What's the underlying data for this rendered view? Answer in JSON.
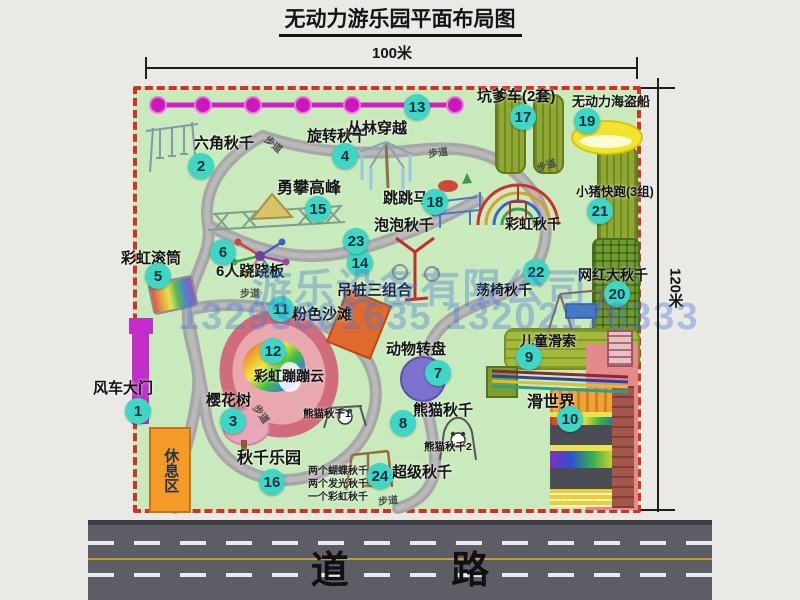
{
  "title": "无动力游乐园平面布局图",
  "dims": {
    "width": "100米",
    "height": "120米"
  },
  "road": {
    "label": "道 路"
  },
  "watermark": {
    "company": "游乐设备有限公司",
    "phones": "13293861635 13202178333"
  },
  "walkway_label": "步道",
  "rest_area_label": "休息区",
  "extra_labels": {
    "rainbow_swing": "彩虹秋千",
    "panda1": "熊猫秋千1",
    "panda2": "熊猫秋千2"
  },
  "attractions": [
    {
      "num": "1",
      "name": "风车大门"
    },
    {
      "num": "2",
      "name": "六角秋千"
    },
    {
      "num": "3",
      "name": "樱花树"
    },
    {
      "num": "4",
      "name": "旋转秋千"
    },
    {
      "num": "5",
      "name": "彩虹滚筒"
    },
    {
      "num": "6",
      "name": "6人跷跷板"
    },
    {
      "num": "7",
      "name": "动物转盘"
    },
    {
      "num": "8",
      "name": "熊猫秋千"
    },
    {
      "num": "9",
      "name": "儿童滑索"
    },
    {
      "num": "10",
      "name": "滑世界"
    },
    {
      "num": "11",
      "name": "粉色沙滩"
    },
    {
      "num": "12",
      "name": "彩虹蹦蹦云"
    },
    {
      "num": "13",
      "name": "丛林穿越"
    },
    {
      "num": "14",
      "name": "吊桩三组合"
    },
    {
      "num": "15",
      "name": "勇攀高峰"
    },
    {
      "num": "16",
      "name": "秋千乐园",
      "sub": [
        "两个蝴蝶秋千",
        "两个发光秋千",
        "一个彩虹秋千"
      ]
    },
    {
      "num": "17",
      "name": "坑爹车(2套)"
    },
    {
      "num": "18",
      "name": "跳跳马"
    },
    {
      "num": "19",
      "name": "无动力海盗船"
    },
    {
      "num": "20",
      "name": "网红大秋千"
    },
    {
      "num": "21",
      "name": "小猪快跑(3组)"
    },
    {
      "num": "22",
      "name": "荡椅秋千"
    },
    {
      "num": "23",
      "name": "泡泡秋千"
    },
    {
      "num": "24",
      "name": "超级秋千"
    }
  ],
  "colors": {
    "park_green": "#c9eabc",
    "border_red": "#d23226",
    "badge_teal": "#3fd6c5",
    "zipline_pink": "#d21ec4",
    "road_gray": "#5d5d66",
    "watermark_blue": "#487ad6"
  }
}
